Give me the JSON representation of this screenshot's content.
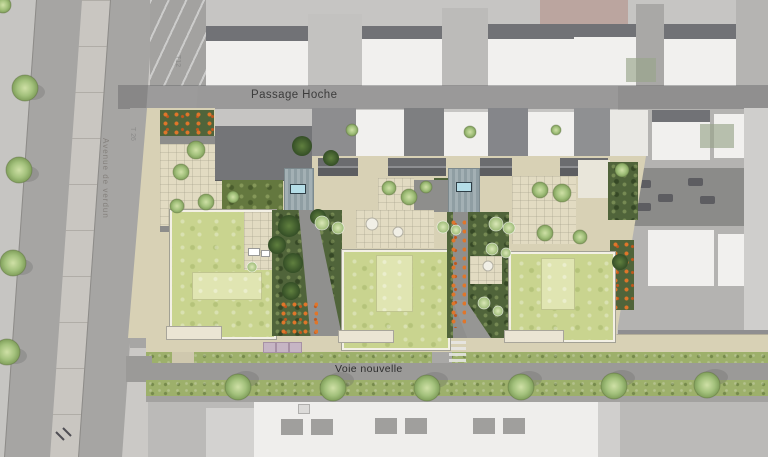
{
  "plan": {
    "streets": {
      "passage_hoche": "Passage Hoche",
      "voie_nouvelle": "Voie nouvelle",
      "avenue": "Avenue de verdun"
    },
    "parcels": {
      "t12": "T12",
      "t26": "T 26"
    },
    "colors": {
      "green_roof": "#c9d48f",
      "green_roof_inner": "#e0e5b2",
      "lawn": "#64783f",
      "garden_dark": "#50643a",
      "verge": "#9db06b",
      "paving": "#d8d1b5",
      "courtyard": "#e2dbc2",
      "road": "#9b9a98",
      "context_roof": "#717276",
      "skylight": "#b5dde7",
      "flower": "#e0762a",
      "red_context": "#b28a81"
    }
  }
}
